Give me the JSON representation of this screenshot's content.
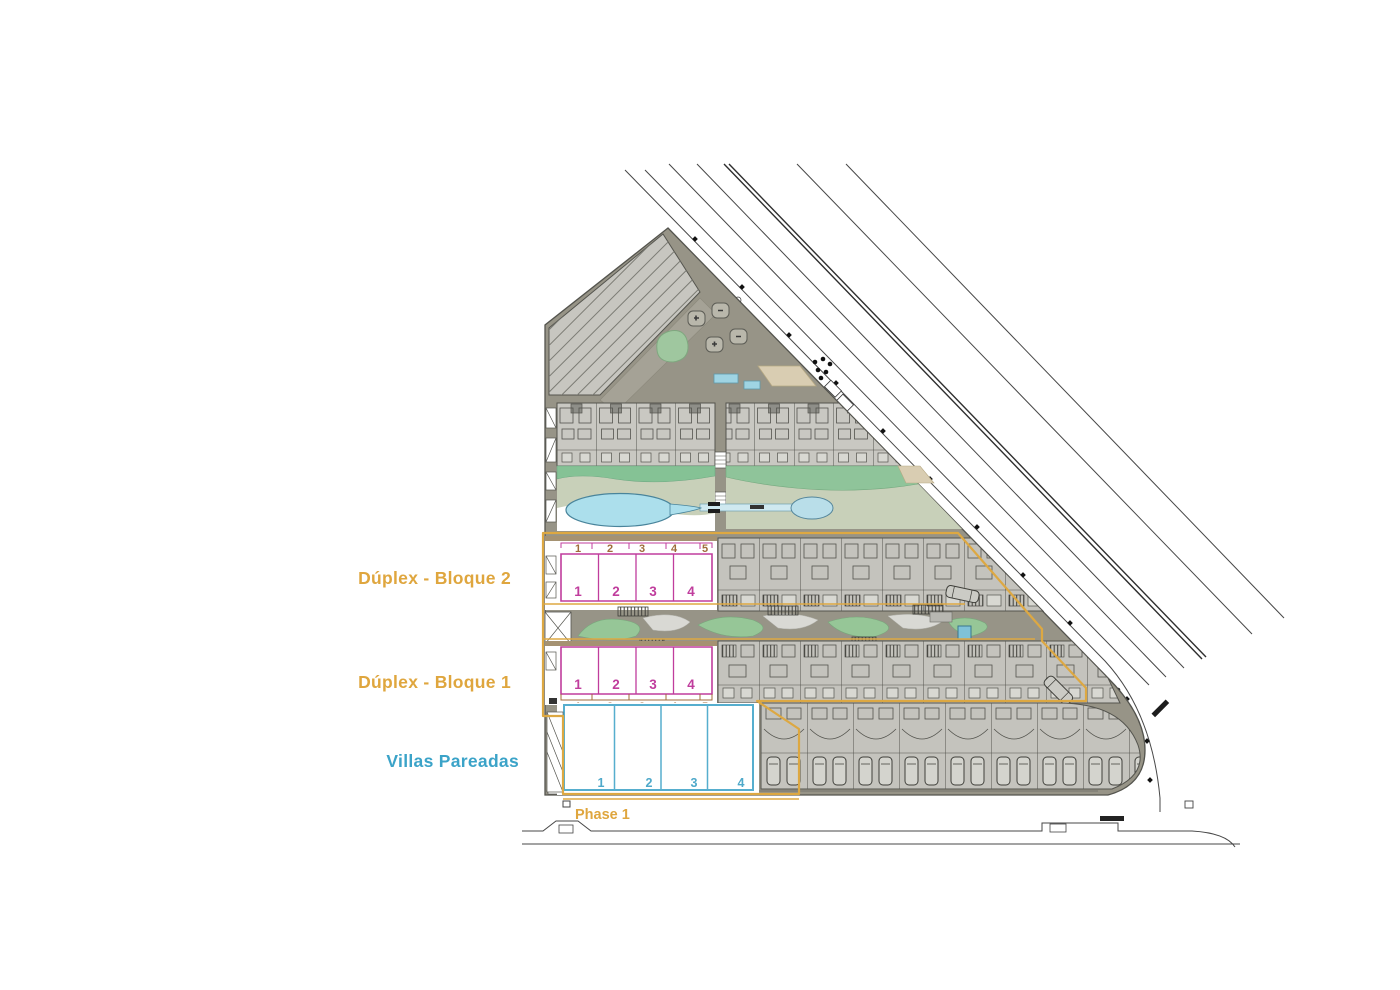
{
  "plan": {
    "labels": {
      "block2": "Dúplex - Bloque 2",
      "block1": "Dúplex - Bloque 1",
      "villas": "Villas Pareadas",
      "phase": "Phase 1"
    },
    "block2": {
      "plot_numbers": [
        "1",
        "2",
        "3",
        "4",
        "5"
      ],
      "unit_numbers": [
        "1",
        "2",
        "3",
        "4"
      ]
    },
    "block1": {
      "plot_numbers": [
        "1",
        "2",
        "3",
        "4",
        "5"
      ],
      "unit_numbers": [
        "1",
        "2",
        "3",
        "4"
      ]
    },
    "villas": {
      "unit_numbers": [
        "1",
        "2",
        "3",
        "4"
      ]
    },
    "colors": {
      "accent_gold": "#DFA63E",
      "accent_magenta": "#C03D9D",
      "accent_cyan": "#4FA9CA",
      "plot_number_brown": "#A06B3B",
      "pool_blue": "#ACDFEC",
      "lawn_green": "#8FC49A",
      "site_ground": "#979487",
      "building_gray": "#C7C6C0"
    }
  }
}
